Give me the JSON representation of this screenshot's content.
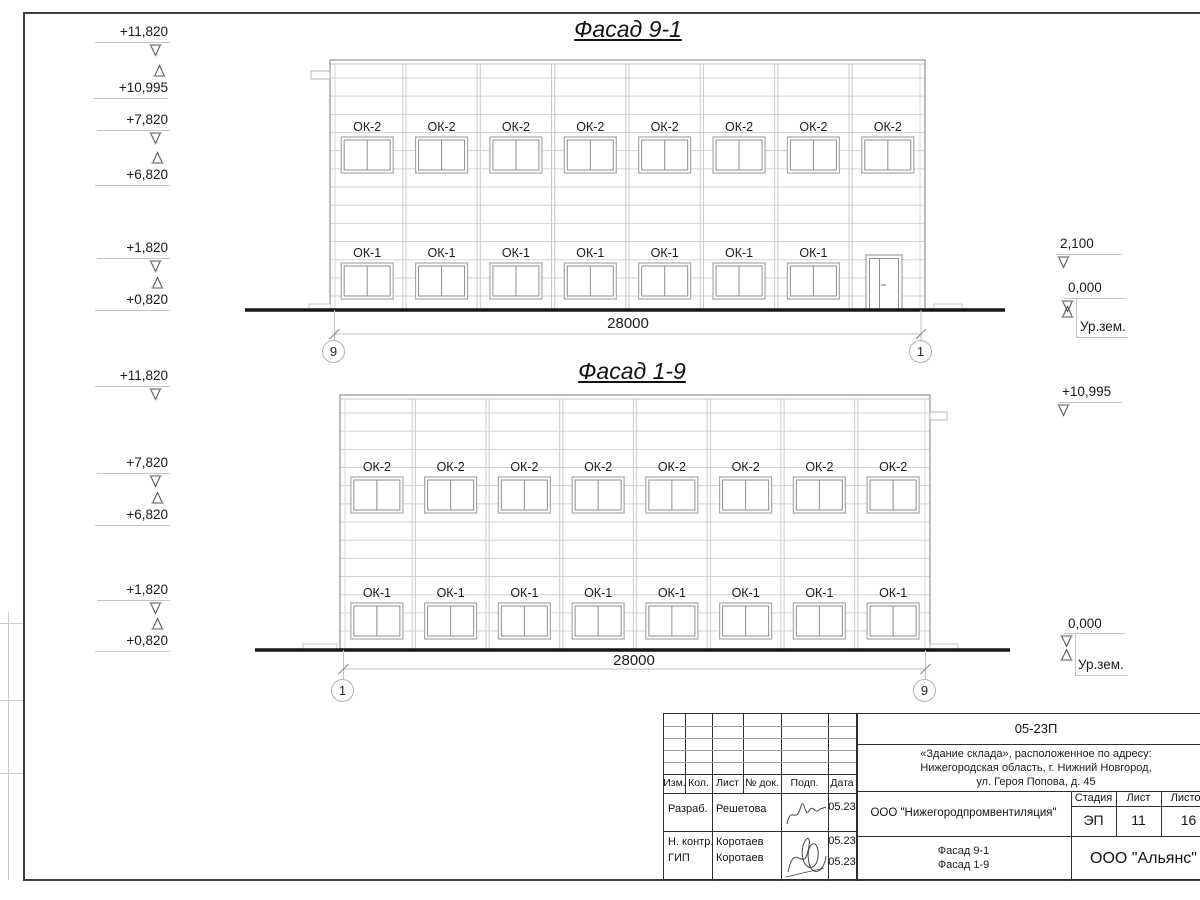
{
  "drawing": {
    "facades": [
      {
        "title": "Фасад 9-1",
        "dimension": "28000",
        "axis_left": "9",
        "axis_right": "1",
        "upper_window_label": "ОК-2",
        "upper_window_count": 8,
        "lower_window_label": "ОК-1",
        "lower_window_count": 7,
        "has_door": true,
        "marks_left": [
          {
            "value": "+11,820",
            "dir": "down"
          },
          {
            "value": "+10,995",
            "dir": "up"
          },
          {
            "value": "+7,820",
            "dir": "down"
          },
          {
            "value": "+6,820",
            "dir": "up"
          },
          {
            "value": "+1,820",
            "dir": "down"
          },
          {
            "value": "+0,820",
            "dir": "up"
          }
        ],
        "marks_right": [
          {
            "value": "2,100",
            "dir": "down"
          },
          {
            "value": "0,000",
            "dir": "down"
          },
          {
            "value": "Ур.зем.",
            "dir": "up"
          }
        ]
      },
      {
        "title": "Фасад 1-9",
        "dimension": "28000",
        "axis_left": "1",
        "axis_right": "9",
        "upper_window_label": "ОК-2",
        "upper_window_count": 8,
        "lower_window_label": "ОК-1",
        "lower_window_count": 8,
        "has_door": false,
        "marks_left": [
          {
            "value": "+11,820",
            "dir": "down"
          },
          {
            "value": "+7,820",
            "dir": "down"
          },
          {
            "value": "+6,820",
            "dir": "up"
          },
          {
            "value": "+1,820",
            "dir": "down"
          },
          {
            "value": "+0,820",
            "dir": "up"
          }
        ],
        "marks_right": [
          {
            "value": "+10,995",
            "dir": "down"
          },
          {
            "value": "0,000",
            "dir": "down"
          },
          {
            "value": "Ур.зем.",
            "dir": "up"
          }
        ]
      }
    ]
  },
  "titleblock": {
    "code": "05-23П",
    "project_lines": [
      "«Здание склада», расположенное по адресу:",
      "Нижегородская область, г. Нижний Новгород,",
      "ул. Героя Попова, д. 45"
    ],
    "org": "ООО \"Нижегородпромвентиляция\"",
    "stage_label": "Стадия",
    "sheet_label": "Лист",
    "sheets_label": "Листов",
    "stage": "ЭП",
    "sheet": "11",
    "sheets": "16",
    "content_line1": "Фасад 9-1",
    "content_line2": "Фасад 1-9",
    "company": "ООО \"Альянс\"",
    "columns": [
      "Изм.",
      "Кол.",
      "Лист",
      "№ док.",
      "Подп.",
      "Дата"
    ],
    "sign_rows": [
      {
        "role": "Разраб.",
        "name": "Решетова",
        "date": "05.23"
      },
      {
        "role": "Н. контр.",
        "name": "Коротаев",
        "date": "05.23"
      },
      {
        "role": "ГИП",
        "name": "Коротаев",
        "date": "05.23"
      }
    ]
  }
}
